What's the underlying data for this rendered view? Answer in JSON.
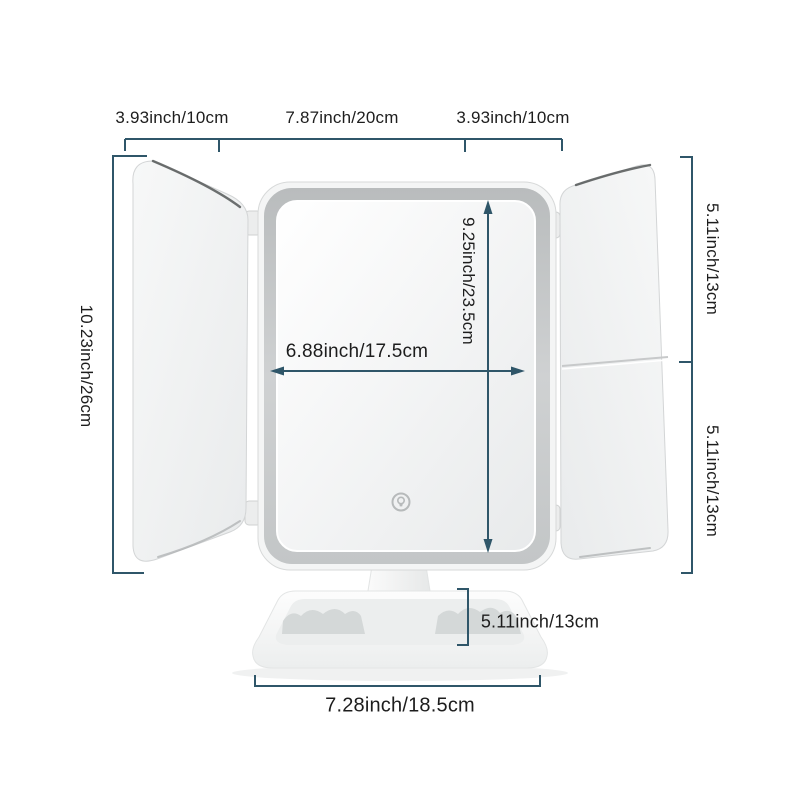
{
  "diagram": {
    "kind": "product-dimension-diagram",
    "colors": {
      "dimension_line": "#2f5669",
      "label_text": "#1d1d1d",
      "frame_band": "#c3c6c7"
    },
    "labels": {
      "top_left_width": "3.93inch/10cm",
      "top_center_width": "7.87inch/20cm",
      "top_right_width": "3.93inch/10cm",
      "total_height": "10.23inch/26cm",
      "mirror_height": "9.25inch/23.5cm",
      "mirror_width": "6.88inch/17.5cm",
      "side_upper_height": "5.11inch/13cm",
      "side_lower_height": "5.11inch/13cm",
      "base_height": "5.11inch/13cm",
      "base_width": "7.28inch/18.5cm"
    },
    "icons": {
      "touch_button": "light-bulb-icon"
    }
  }
}
